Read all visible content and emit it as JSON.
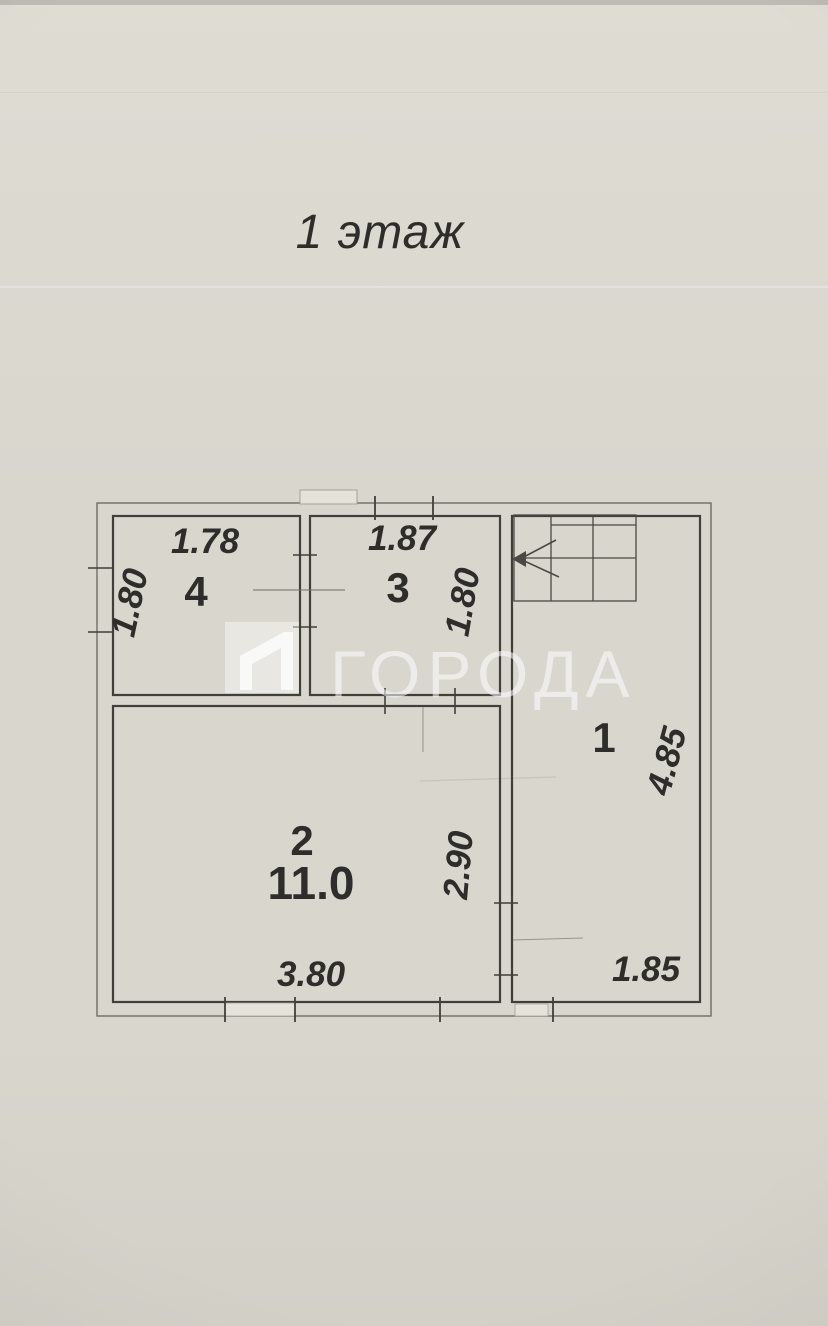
{
  "page": {
    "title": "1 этаж"
  },
  "watermark": {
    "text": "ГОРОДА",
    "logo": "goroda-logo"
  },
  "colors": {
    "paper": "#d8d6cd",
    "ink": "#2e2d2a",
    "wall": "#403f3a",
    "watermark": "rgba(255,255,255,0.55)"
  },
  "floor_plan": {
    "floor_label": "1 этаж",
    "rooms": [
      {
        "number": "1",
        "height_dim": "4.85",
        "width_dim": "1.85"
      },
      {
        "number": "2",
        "area": "11.0",
        "width_dim": "3.80",
        "height_dim": "2.90"
      },
      {
        "number": "3",
        "width_dim": "1.87",
        "height_dim": "1.80"
      },
      {
        "number": "4",
        "width_dim": "1.78",
        "height_dim": "1.80"
      }
    ],
    "features": [
      "staircase-with-direction-arrow",
      "window-marks",
      "door-openings"
    ]
  }
}
